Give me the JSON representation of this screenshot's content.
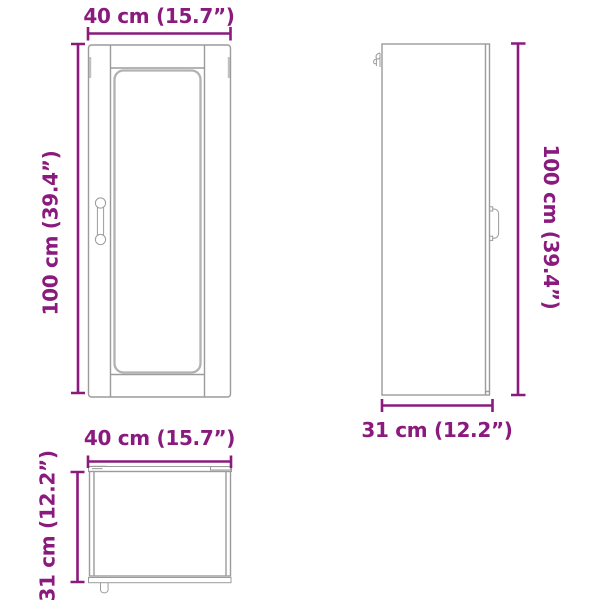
{
  "diagram": {
    "subject": "wall-cabinet-dimension-drawing",
    "colors": {
      "dimension_accent": "#8a1a7d",
      "drawing_line": "#9b9b9b",
      "drawing_line_heavy": "#b2b2b2"
    },
    "front_view": {
      "width_label": "40 cm (15.7”)",
      "height_label": "100 cm (39.4”)"
    },
    "side_view": {
      "height_label": "100 cm (39.4”)",
      "depth_label": "31 cm (12.2”)"
    },
    "top_view": {
      "width_label": "40 cm (15.7”)",
      "depth_label": "31 cm (12.2”)"
    }
  }
}
